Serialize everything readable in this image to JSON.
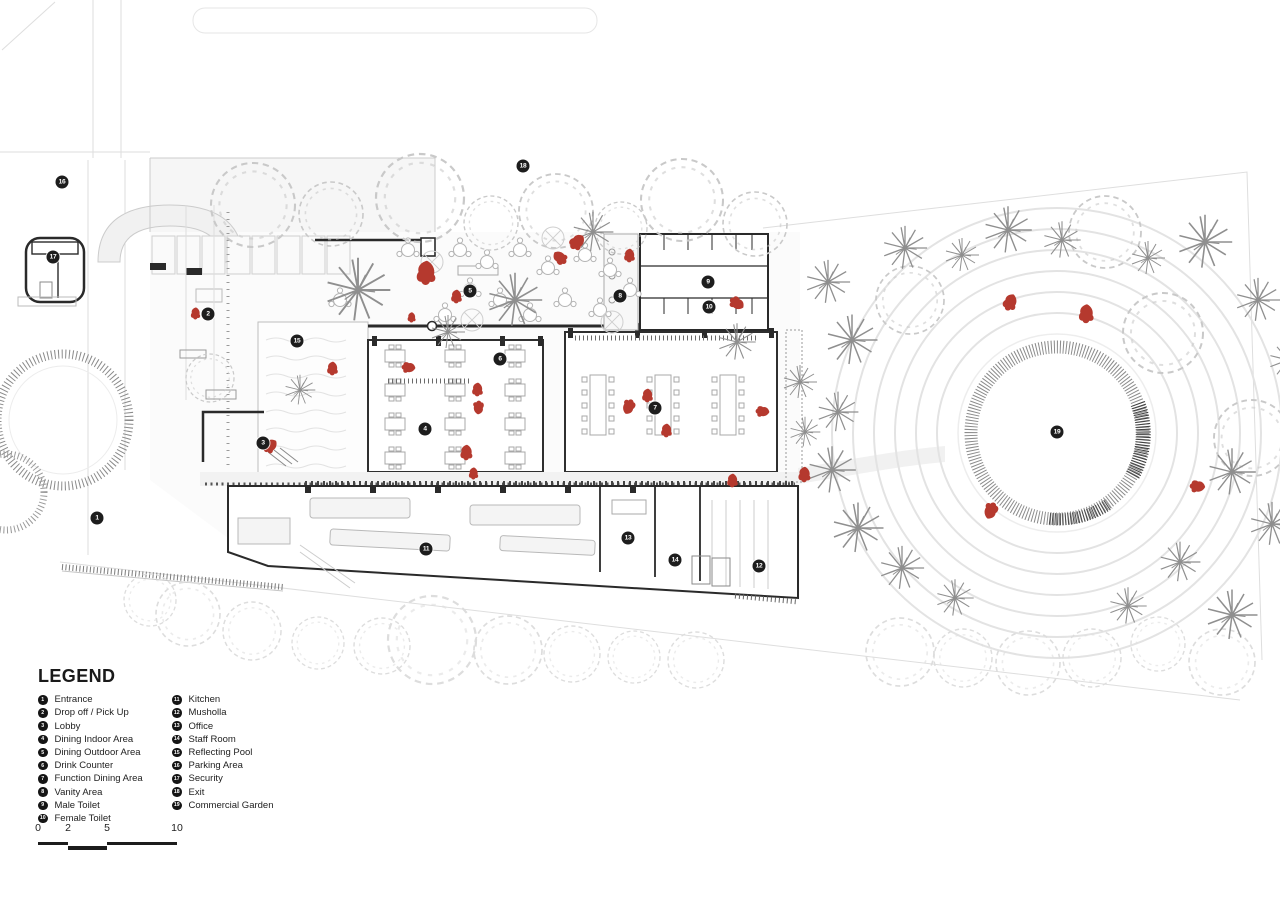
{
  "legend": {
    "title": "LEGEND",
    "items": [
      {
        "num": "1",
        "label": "Entrance"
      },
      {
        "num": "2",
        "label": "Drop off / Pick Up"
      },
      {
        "num": "3",
        "label": "Lobby"
      },
      {
        "num": "4",
        "label": "Dining Indoor Area"
      },
      {
        "num": "5",
        "label": "Dining Outdoor Area"
      },
      {
        "num": "6",
        "label": "Drink Counter"
      },
      {
        "num": "7",
        "label": "Function Dining Area"
      },
      {
        "num": "8",
        "label": "Vanity Area"
      },
      {
        "num": "9",
        "label": "Male Toilet"
      },
      {
        "num": "10",
        "label": "Female Toilet"
      },
      {
        "num": "11",
        "label": "Kitchen"
      },
      {
        "num": "12",
        "label": "Musholla"
      },
      {
        "num": "13",
        "label": "Office"
      },
      {
        "num": "14",
        "label": "Staff Room"
      },
      {
        "num": "15",
        "label": "Reflecting Pool"
      },
      {
        "num": "16",
        "label": "Parking Area"
      },
      {
        "num": "17",
        "label": "Security"
      },
      {
        "num": "18",
        "label": "Exit"
      },
      {
        "num": "19",
        "label": "Commercial Garden"
      }
    ]
  },
  "plan": {
    "markers": [
      {
        "num": "1",
        "x": 97,
        "y": 518,
        "label": "Entrance"
      },
      {
        "num": "2",
        "x": 208,
        "y": 314,
        "label": "Drop off / Pick Up"
      },
      {
        "num": "3",
        "x": 263,
        "y": 443,
        "label": "Lobby"
      },
      {
        "num": "4",
        "x": 425,
        "y": 429,
        "label": "Dining Indoor Area"
      },
      {
        "num": "5",
        "x": 470,
        "y": 291,
        "label": "Dining Outdoor Area"
      },
      {
        "num": "6",
        "x": 500,
        "y": 359,
        "label": "Drink Counter"
      },
      {
        "num": "7",
        "x": 655,
        "y": 408,
        "label": "Function Dining Area"
      },
      {
        "num": "8",
        "x": 620,
        "y": 296,
        "label": "Vanity Area"
      },
      {
        "num": "9",
        "x": 708,
        "y": 282,
        "label": "Male Toilet"
      },
      {
        "num": "10",
        "x": 709,
        "y": 307,
        "label": "Female Toilet"
      },
      {
        "num": "11",
        "x": 426,
        "y": 549,
        "label": "Kitchen"
      },
      {
        "num": "12",
        "x": 759,
        "y": 566,
        "label": "Musholla"
      },
      {
        "num": "13",
        "x": 628,
        "y": 538,
        "label": "Office"
      },
      {
        "num": "14",
        "x": 675,
        "y": 560,
        "label": "Staff Room"
      },
      {
        "num": "15",
        "x": 297,
        "y": 341,
        "label": "Reflecting Pool"
      },
      {
        "num": "16",
        "x": 62,
        "y": 182,
        "label": "Parking Area"
      },
      {
        "num": "17",
        "x": 53,
        "y": 257,
        "label": "Security"
      },
      {
        "num": "18",
        "x": 523,
        "y": 166,
        "label": "Exit"
      },
      {
        "num": "19",
        "x": 1057,
        "y": 432,
        "label": "Commercial Garden"
      }
    ]
  },
  "scale_bar": {
    "labels": [
      "0",
      "2",
      "5",
      "10"
    ]
  },
  "colors": {
    "accent_red": "#b5392e",
    "wall_dark": "#2a2a2a",
    "marker_bg": "#1d1d1d",
    "tree_gray": "#c9c9c9",
    "palm_gray": "#8f8f8f",
    "faint_line": "#e0e0e0"
  }
}
